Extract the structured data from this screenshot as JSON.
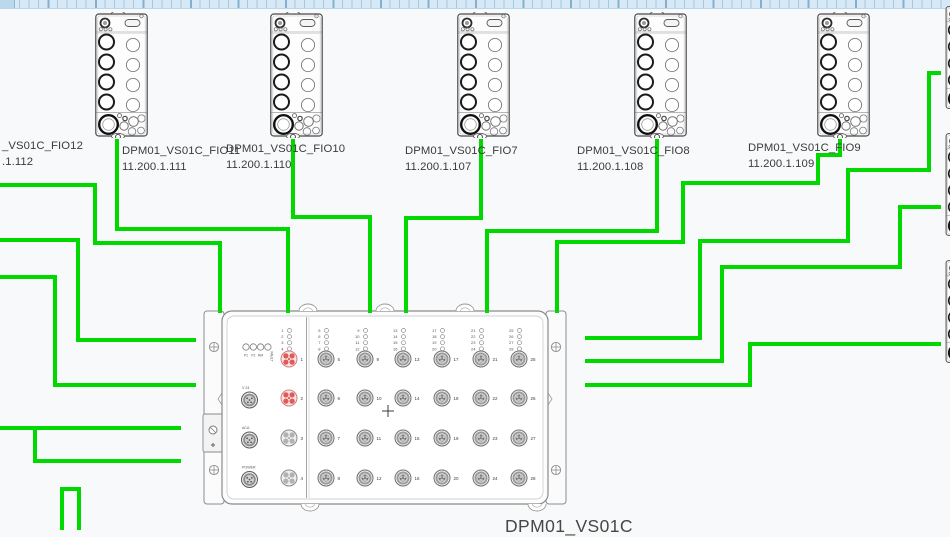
{
  "app": {
    "background": "#f8f9fa"
  },
  "wire_style": {
    "color": "#00d800",
    "width": 4
  },
  "top_modules": [
    {
      "id": "fio12",
      "label": "_VS01C_FIO12",
      "ip": ".1.112",
      "label_x": 2,
      "label_y": 139,
      "module_x": null
    },
    {
      "id": "fio11",
      "label": "DPM01_VS01C_FIO11",
      "ip": "11.200.1.111",
      "label_x": 122,
      "label_y": 144,
      "module_x": 95
    },
    {
      "id": "fio10",
      "label": "DPM01_VS01C_FIO10",
      "ip": "11.200.1.110",
      "label_x": 226,
      "label_y": 142,
      "module_x": 270
    },
    {
      "id": "fio7",
      "label": "DPM01_VS01C_FIO7",
      "ip": "11.200.1.107",
      "label_x": 405,
      "label_y": 144,
      "module_x": 457
    },
    {
      "id": "fio8",
      "label": "DPM01_VS01C_FIO8",
      "ip": "11.200.1.108",
      "label_x": 577,
      "label_y": 144,
      "module_x": 634
    },
    {
      "id": "fio9",
      "label": "DPM01_VS01C_FIO9",
      "ip": "11.200.1.109",
      "label_x": 748,
      "label_y": 141,
      "module_x": 817
    }
  ],
  "right_modules": [
    {
      "id": "right-module-top",
      "y": 5
    },
    {
      "id": "right-module-mid",
      "y": 132
    },
    {
      "id": "right-module-bottom",
      "y": 259
    }
  ],
  "wires": [
    {
      "id": "wire-fio12",
      "points": [
        [
          0,
          185
        ],
        [
          95,
          185
        ],
        [
          95,
          243
        ],
        [
          220,
          243
        ],
        [
          220,
          313
        ]
      ]
    },
    {
      "id": "wire-fio11",
      "points": [
        [
          117,
          139
        ],
        [
          117,
          229
        ],
        [
          288,
          229
        ],
        [
          288,
          313
        ]
      ]
    },
    {
      "id": "wire-fio10",
      "points": [
        [
          293,
          139
        ],
        [
          293,
          217
        ],
        [
          370,
          217
        ],
        [
          370,
          313
        ]
      ]
    },
    {
      "id": "wire-fio7",
      "points": [
        [
          481,
          139
        ],
        [
          481,
          218
        ],
        [
          406,
          218
        ],
        [
          406,
          313
        ]
      ]
    },
    {
      "id": "wire-fio8",
      "points": [
        [
          657,
          139
        ],
        [
          657,
          231
        ],
        [
          487,
          231
        ],
        [
          487,
          313
        ]
      ]
    },
    {
      "id": "wire-fio9",
      "points": [
        [
          840,
          139
        ],
        [
          840,
          155
        ],
        [
          818,
          155
        ],
        [
          818,
          183
        ],
        [
          683,
          183
        ],
        [
          683,
          242
        ],
        [
          557,
          242
        ],
        [
          557,
          313
        ]
      ]
    },
    {
      "id": "wire-right-top",
      "points": [
        [
          941,
          73
        ],
        [
          929,
          73
        ],
        [
          929,
          170
        ],
        [
          848,
          170
        ],
        [
          848,
          241
        ],
        [
          700,
          241
        ],
        [
          700,
          338
        ],
        [
          585,
          338
        ]
      ]
    },
    {
      "id": "wire-right-mid",
      "points": [
        [
          941,
          207
        ],
        [
          900,
          207
        ],
        [
          900,
          267
        ],
        [
          722,
          267
        ],
        [
          722,
          361
        ],
        [
          585,
          361
        ]
      ]
    },
    {
      "id": "wire-right-bottom",
      "points": [
        [
          941,
          344
        ],
        [
          750,
          344
        ],
        [
          750,
          385
        ],
        [
          585,
          385
        ]
      ]
    },
    {
      "id": "wire-left-a",
      "points": [
        [
          0,
          240
        ],
        [
          78,
          240
        ],
        [
          78,
          340
        ],
        [
          196,
          340
        ]
      ]
    },
    {
      "id": "wire-left-b",
      "points": [
        [
          0,
          277
        ],
        [
          55,
          277
        ],
        [
          55,
          385
        ],
        [
          196,
          385
        ]
      ]
    },
    {
      "id": "wire-left-c",
      "points": [
        [
          0,
          428
        ],
        [
          181,
          428
        ]
      ]
    },
    {
      "id": "wire-left-d",
      "points": [
        [
          35,
          426
        ],
        [
          35,
          461
        ],
        [
          181,
          461
        ]
      ]
    },
    {
      "id": "wire-left-e",
      "points": [
        [
          62,
          531
        ],
        [
          62,
          489
        ],
        [
          79,
          489
        ],
        [
          79,
          531
        ]
      ]
    }
  ],
  "central_device": {
    "label": "DPM01_VS01C",
    "status_leds": [
      "P1",
      "P2",
      "RM",
      "FAULT"
    ],
    "aux_ports": [
      "V 24",
      "ACA",
      "POWER"
    ],
    "port_numbers": [
      1,
      2,
      3,
      4,
      5,
      6,
      7,
      8,
      9,
      10,
      11,
      12,
      13,
      14,
      15,
      16,
      17,
      18,
      19,
      20,
      21,
      22,
      23,
      24,
      25,
      26,
      27,
      28
    ],
    "highlighted_ports": [
      1,
      2
    ],
    "highlight_color": "#e05a5a"
  }
}
